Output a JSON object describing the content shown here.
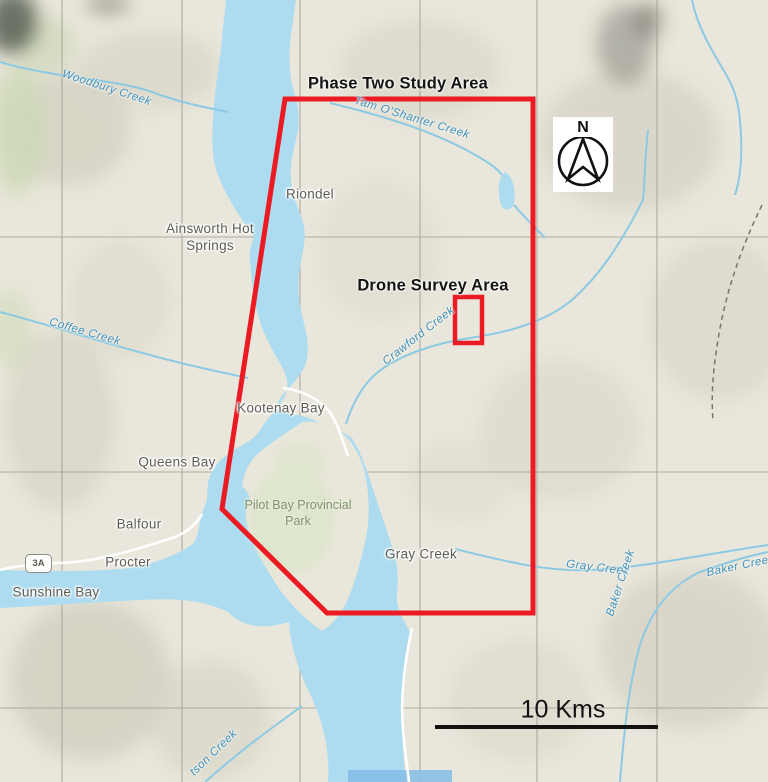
{
  "map": {
    "title_context": "Topographic map of Kootenay Lake area",
    "annotations": {
      "phase_two_label": "Phase Two Study Area",
      "drone_label": "Drone Survey Area"
    },
    "places": {
      "riondel": "Riondel",
      "ainsworth": "Ainsworth Hot Springs",
      "kootenay_bay": "Kootenay Bay",
      "queens_bay": "Queens Bay",
      "balfour": "Balfour",
      "procter": "Procter",
      "sunshine_bay": "Sunshine Bay",
      "gray_creek_town": "Gray Creek",
      "pilot_bay_park": "Pilot Bay Provincial Park"
    },
    "creeks": {
      "woodbury": "Woodbury Creek",
      "coffee": "Coffee Creek",
      "tam_o_shanter": "Tam O'Shanter Creek",
      "crawford": "Crawford Creek",
      "gray": "Gray Creek",
      "baker_upper": "Baker Creek",
      "baker_lower": "Baker Creek",
      "southwest_partial": "tson Creek"
    },
    "compass_letter": "N",
    "scale_bar_label": "10 Kms",
    "highway_shield": "3A",
    "colors": {
      "study_area_red": "#EC1B23",
      "water": "#ADDCF1",
      "land": "#E9E6DB",
      "place_label": "#5D5C55",
      "creek_label": "#4191BD",
      "park_label": "#80936A"
    }
  }
}
